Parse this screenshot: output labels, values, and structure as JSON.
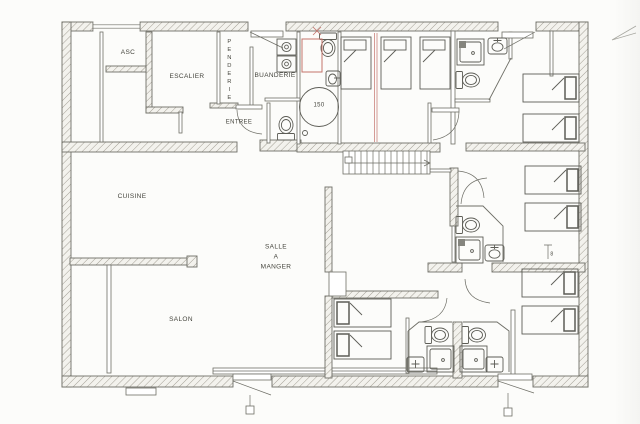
{
  "labels": {
    "asc": "ASC",
    "escalier": "ESCALIER",
    "penderie": "PENDERIE",
    "buanderie": "BUANDERIE",
    "entree": "ENTREE",
    "cuisine": "CUISINE",
    "salle_a_manger": "SALLE\nA\nMANGER",
    "salon": "SALON",
    "water_heater_capacity": "150",
    "wall_marker": "8"
  },
  "icons": {
    "bed": "bed-icon",
    "toilet": "toilet-icon",
    "shower": "shower-icon",
    "sink": "sink-icon",
    "washing_machine": "washing-machine-icon",
    "water_heater": "water-heater-icon",
    "staircase": "staircase-icon",
    "door_swing": "door-swing-icon",
    "window": "window-icon",
    "elevator": "elevator-icon"
  },
  "colors": {
    "background": "#fcfcfa",
    "line": "#6e6e66",
    "text": "#45453d",
    "red_mark": "#c5736b",
    "fixture": "#5d5d56"
  }
}
